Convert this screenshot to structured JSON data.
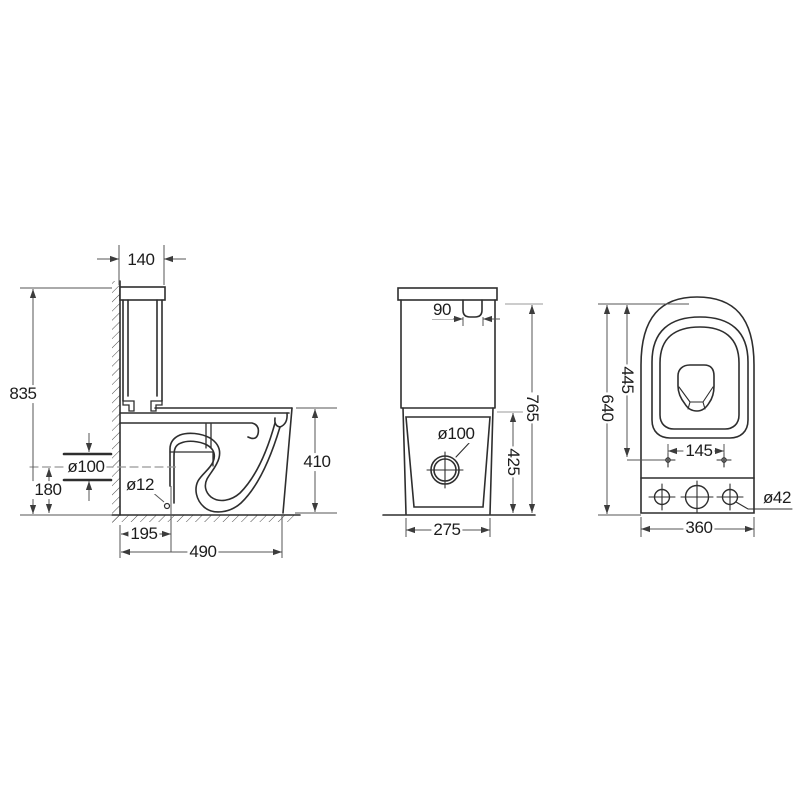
{
  "drawing": {
    "type": "toilet-technical-drawing",
    "background_color": "#ffffff",
    "outline_color": "#2e2e2e",
    "dimension_color": "#555555",
    "centerline_color": "#979797",
    "side_view": {
      "tank_width": "140",
      "overall_height": "835",
      "outlet_diameter": "ø100",
      "outlet_center_height": "180",
      "fixing_hole_diameter": "ø12",
      "outlet_setback": "195",
      "overall_depth": "490",
      "bowl_height": "410"
    },
    "front_view": {
      "flush_button_width": "90",
      "tank_top_height": "765",
      "drain_diameter": "ø100",
      "bowl_rim_height": "425",
      "base_width": "275"
    },
    "top_view": {
      "overall_depth": "640",
      "seat_bolt_setback": "445",
      "seat_bolt_spacing": "145",
      "hole_diameter": "ø42",
      "overall_width": "360"
    }
  }
}
